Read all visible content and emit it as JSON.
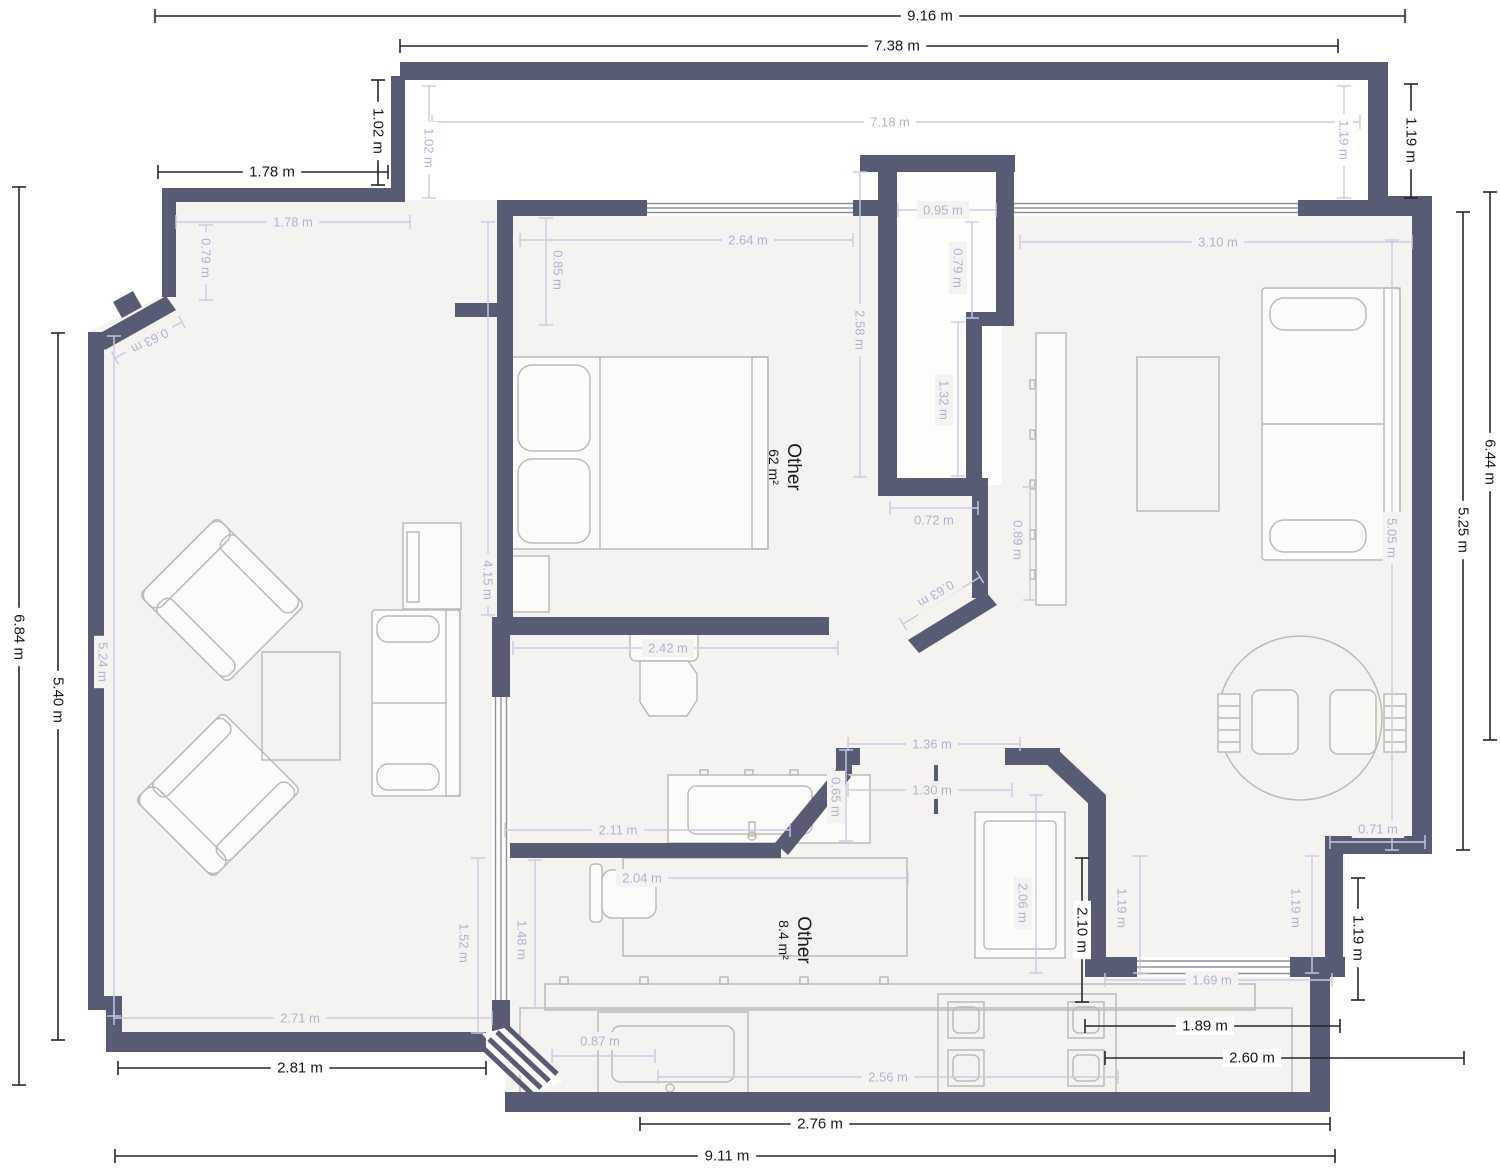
{
  "plan": {
    "units": "m",
    "colors": {
      "wall": "#575b73",
      "floor": "#f4f3ef",
      "dimension_dark": "#17181c",
      "dimension_light": "#aeb2d6",
      "furniture_outline": "#bcbbb6"
    },
    "rooms": [
      {
        "name": "Other",
        "area": "62 m²",
        "x": 788,
        "y": 467,
        "r": 90
      },
      {
        "name": "Other",
        "area": "8.4 m²",
        "x": 798,
        "y": 940,
        "r": 90
      }
    ],
    "dimensions": [
      {
        "t": "9.16 m",
        "x": 930,
        "y": 16,
        "r": 0,
        "tone": "dark",
        "l": [
          155,
          16,
          1405,
          16
        ]
      },
      {
        "t": "7.38 m",
        "x": 897,
        "y": 46,
        "r": 0,
        "tone": "dark",
        "l": [
          400,
          46,
          1338,
          46
        ]
      },
      {
        "t": "1.02 m",
        "x": 378,
        "y": 131,
        "r": 90,
        "tone": "dark",
        "l": [
          378,
          80,
          378,
          185
        ]
      },
      {
        "t": "1.78 m",
        "x": 272,
        "y": 172,
        "r": 0,
        "tone": "dark",
        "l": [
          158,
          172,
          388,
          172
        ]
      },
      {
        "t": "1.19 m",
        "x": 1411,
        "y": 140,
        "r": 90,
        "tone": "dark",
        "l": [
          1411,
          84,
          1411,
          198
        ]
      },
      {
        "t": "6.44 m",
        "x": 1490,
        "y": 462,
        "r": 90,
        "tone": "dark",
        "l": [
          1490,
          192,
          1490,
          740
        ]
      },
      {
        "t": "5.25 m",
        "x": 1463,
        "y": 530,
        "r": 90,
        "tone": "dark",
        "l": [
          1463,
          212,
          1463,
          850
        ]
      },
      {
        "t": "1.19 m",
        "x": 1358,
        "y": 938,
        "r": 90,
        "tone": "dark",
        "l": [
          1358,
          878,
          1358,
          1000
        ]
      },
      {
        "t": "2.10 m",
        "x": 1082,
        "y": 930,
        "r": 90,
        "tone": "dark",
        "l": [
          1082,
          858,
          1082,
          1002
        ]
      },
      {
        "t": "1.89 m",
        "x": 1205,
        "y": 1026,
        "r": 0,
        "tone": "dark",
        "l": [
          1085,
          1026,
          1340,
          1026
        ]
      },
      {
        "t": "2.60 m",
        "x": 1252,
        "y": 1058,
        "r": 0,
        "tone": "dark",
        "l": [
          1105,
          1058,
          1464,
          1058
        ]
      },
      {
        "t": "2.81 m",
        "x": 300,
        "y": 1068,
        "r": 0,
        "tone": "dark",
        "l": [
          118,
          1068,
          486,
          1068
        ]
      },
      {
        "t": "2.76 m",
        "x": 820,
        "y": 1124,
        "r": 0,
        "tone": "dark",
        "l": [
          640,
          1124,
          1330,
          1124
        ]
      },
      {
        "t": "9.11 m",
        "x": 727,
        "y": 1156,
        "r": 0,
        "tone": "dark",
        "l": [
          115,
          1156,
          1335,
          1156
        ]
      },
      {
        "t": "6.84 m",
        "x": 19,
        "y": 637,
        "r": 90,
        "tone": "dark",
        "l": [
          19,
          187,
          19,
          1085
        ]
      },
      {
        "t": "5.40 m",
        "x": 58,
        "y": 700,
        "r": 90,
        "tone": "dark",
        "l": [
          58,
          333,
          58,
          1040
        ]
      },
      {
        "t": "7.18 m",
        "x": 890,
        "y": 122,
        "r": 0,
        "tone": "light",
        "l": [
          432,
          122,
          1360,
          122
        ],
        "bg": "#ffffff"
      },
      {
        "t": "1.02 m",
        "x": 429,
        "y": 148,
        "r": 90,
        "tone": "light",
        "l": [
          429,
          86,
          429,
          198
        ],
        "bg": "#ffffff"
      },
      {
        "t": "1.19 m",
        "x": 1344,
        "y": 140,
        "r": 90,
        "tone": "light",
        "l": [
          1344,
          86,
          1344,
          198
        ],
        "bg": "#ffffff"
      },
      {
        "t": "1.78 m",
        "x": 293,
        "y": 222,
        "r": 0,
        "tone": "light",
        "l": [
          176,
          222,
          410,
          222
        ]
      },
      {
        "t": "0.79 m",
        "x": 206,
        "y": 258,
        "r": 90,
        "tone": "light",
        "l": [
          206,
          225,
          206,
          300
        ]
      },
      {
        "t": "0.63 m",
        "x": 150,
        "y": 341,
        "r": 153,
        "tone": "light",
        "l": [
          115,
          358,
          182,
          322
        ]
      },
      {
        "t": "2.64 m",
        "x": 748,
        "y": 240,
        "r": 0,
        "tone": "light",
        "l": [
          520,
          240,
          853,
          240
        ]
      },
      {
        "t": "0.85 m",
        "x": 558,
        "y": 270,
        "r": 90,
        "tone": "light",
        "l": [
          546,
          218,
          546,
          325
        ]
      },
      {
        "t": "2.58 m",
        "x": 860,
        "y": 330,
        "r": 90,
        "tone": "light",
        "l": [
          860,
          172,
          860,
          477
        ]
      },
      {
        "t": "0.95 m",
        "x": 943,
        "y": 210,
        "r": 0,
        "tone": "light",
        "l": [
          898,
          210,
          996,
          210
        ]
      },
      {
        "t": "0.79 m",
        "x": 958,
        "y": 268,
        "r": 90,
        "tone": "light",
        "l": [
          972,
          222,
          972,
          318
        ]
      },
      {
        "t": "1.32 m",
        "x": 944,
        "y": 400,
        "r": 90,
        "tone": "light",
        "l": [
          958,
          322,
          958,
          476
        ]
      },
      {
        "t": "0.72 m",
        "x": 934,
        "y": 520,
        "r": 0,
        "tone": "light",
        "l": [
          890,
          508,
          978,
          508
        ]
      },
      {
        "t": "3.10 m",
        "x": 1218,
        "y": 242,
        "r": 0,
        "tone": "light",
        "l": [
          1020,
          242,
          1412,
          242
        ]
      },
      {
        "t": "5.05 m",
        "x": 1392,
        "y": 538,
        "r": 90,
        "tone": "light",
        "l": [
          1392,
          240,
          1392,
          850
        ]
      },
      {
        "t": "0.89 m",
        "x": 1018,
        "y": 540,
        "r": 90,
        "tone": "light",
        "l": [
          1030,
          487,
          1030,
          600
        ]
      },
      {
        "t": "0.63 m",
        "x": 936,
        "y": 594,
        "r": 148,
        "tone": "light",
        "l": [
          903,
          624,
          980,
          577
        ]
      },
      {
        "t": "2.42 m",
        "x": 668,
        "y": 648,
        "r": 0,
        "tone": "light",
        "l": [
          513,
          648,
          838,
          648
        ]
      },
      {
        "t": "4.15 m",
        "x": 488,
        "y": 580,
        "r": 90,
        "tone": "light",
        "l": [
          488,
          222,
          488,
          615
        ]
      },
      {
        "t": "2.11 m",
        "x": 618,
        "y": 830,
        "r": 0,
        "tone": "light",
        "l": [
          505,
          830,
          790,
          830
        ]
      },
      {
        "t": "0.65 m",
        "x": 836,
        "y": 797,
        "r": 90,
        "tone": "light",
        "l": [
          846,
          750,
          846,
          841
        ]
      },
      {
        "t": "1.36 m",
        "x": 932,
        "y": 744,
        "r": 0,
        "tone": "light",
        "l": [
          848,
          744,
          1020,
          744
        ]
      },
      {
        "t": "1.30 m",
        "x": 932,
        "y": 790,
        "r": 0,
        "tone": "light",
        "l": [
          848,
          790,
          1012,
          790
        ]
      },
      {
        "t": "2.04 m",
        "x": 642,
        "y": 878,
        "r": 0,
        "tone": "light",
        "l": [
          628,
          878,
          908,
          878
        ]
      },
      {
        "t": "2.06 m",
        "x": 1023,
        "y": 903,
        "r": 90,
        "tone": "light",
        "l": [
          1036,
          795,
          1036,
          973
        ]
      },
      {
        "t": "1.19 m",
        "x": 1122,
        "y": 908,
        "r": 90,
        "tone": "light",
        "l": [
          1140,
          856,
          1140,
          973
        ]
      },
      {
        "t": "1.19 m",
        "x": 1296,
        "y": 908,
        "r": 90,
        "tone": "light",
        "l": [
          1312,
          856,
          1312,
          973
        ]
      },
      {
        "t": "0.71 m",
        "x": 1378,
        "y": 829,
        "r": 0,
        "tone": "light",
        "l": [
          1330,
          842,
          1425,
          842
        ]
      },
      {
        "t": "1.69 m",
        "x": 1212,
        "y": 980,
        "r": 0,
        "tone": "light",
        "l": [
          1105,
          980,
          1332,
          980
        ]
      },
      {
        "t": "2.71 m",
        "x": 300,
        "y": 1018,
        "r": 0,
        "tone": "light",
        "l": [
          114,
          1018,
          492,
          1018
        ]
      },
      {
        "t": "1.52 m",
        "x": 464,
        "y": 943,
        "r": 90,
        "tone": "light",
        "l": [
          478,
          858,
          478,
          1033
        ]
      },
      {
        "t": "1.48 m",
        "x": 522,
        "y": 940,
        "r": 90,
        "tone": "light",
        "l": [
          535,
          860,
          535,
          1008
        ]
      },
      {
        "t": "0.87 m",
        "x": 600,
        "y": 1041,
        "r": 0,
        "tone": "light",
        "l": [
          552,
          1056,
          655,
          1056
        ]
      },
      {
        "t": "2.56 m",
        "x": 888,
        "y": 1077,
        "r": 0,
        "tone": "light",
        "l": [
          658,
          1077,
          1118,
          1077
        ]
      },
      {
        "t": "5.24 m",
        "x": 103,
        "y": 662,
        "r": 90,
        "tone": "light",
        "l": [
          114,
          336,
          114,
          1016
        ]
      }
    ]
  }
}
